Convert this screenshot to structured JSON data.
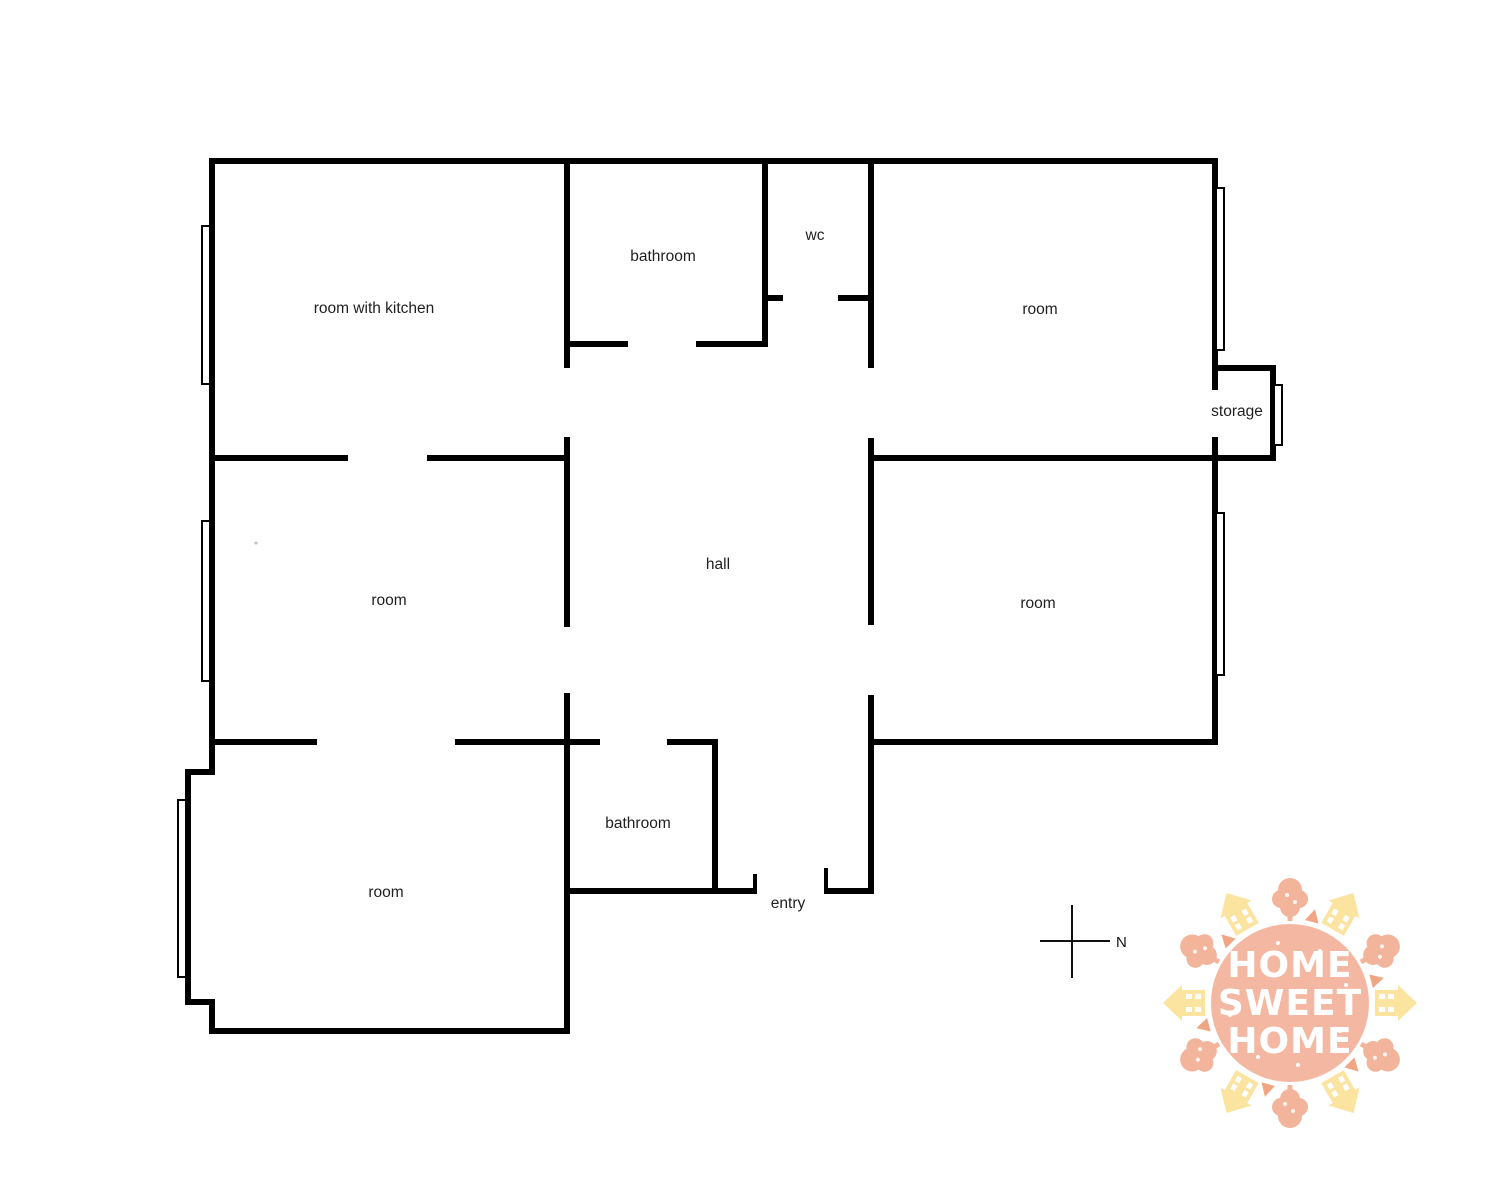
{
  "colors": {
    "wall": "#000000",
    "label": "#1f1f1f",
    "logo-circle": "#f4b7a1",
    "logo-house": "#fbe3a0",
    "logo-tree": "#f3b49c",
    "logo-ray": "#f0a685",
    "logo-text": "#ffffff"
  },
  "rooms": {
    "room_with_kitchen": "room with kitchen",
    "bathroom_top": "bathroom",
    "wc": "wc",
    "room_top_right": "room",
    "storage": "storage",
    "room_middle_left": "room",
    "hall": "hall",
    "room_middle_right": "room",
    "room_bottom_left": "room",
    "bathroom_bottom": "bathroom",
    "entry": "entry"
  },
  "compass": {
    "north": "N"
  },
  "logo": {
    "line1": "HOME",
    "line2": "SWEET",
    "line3": "HOME"
  }
}
